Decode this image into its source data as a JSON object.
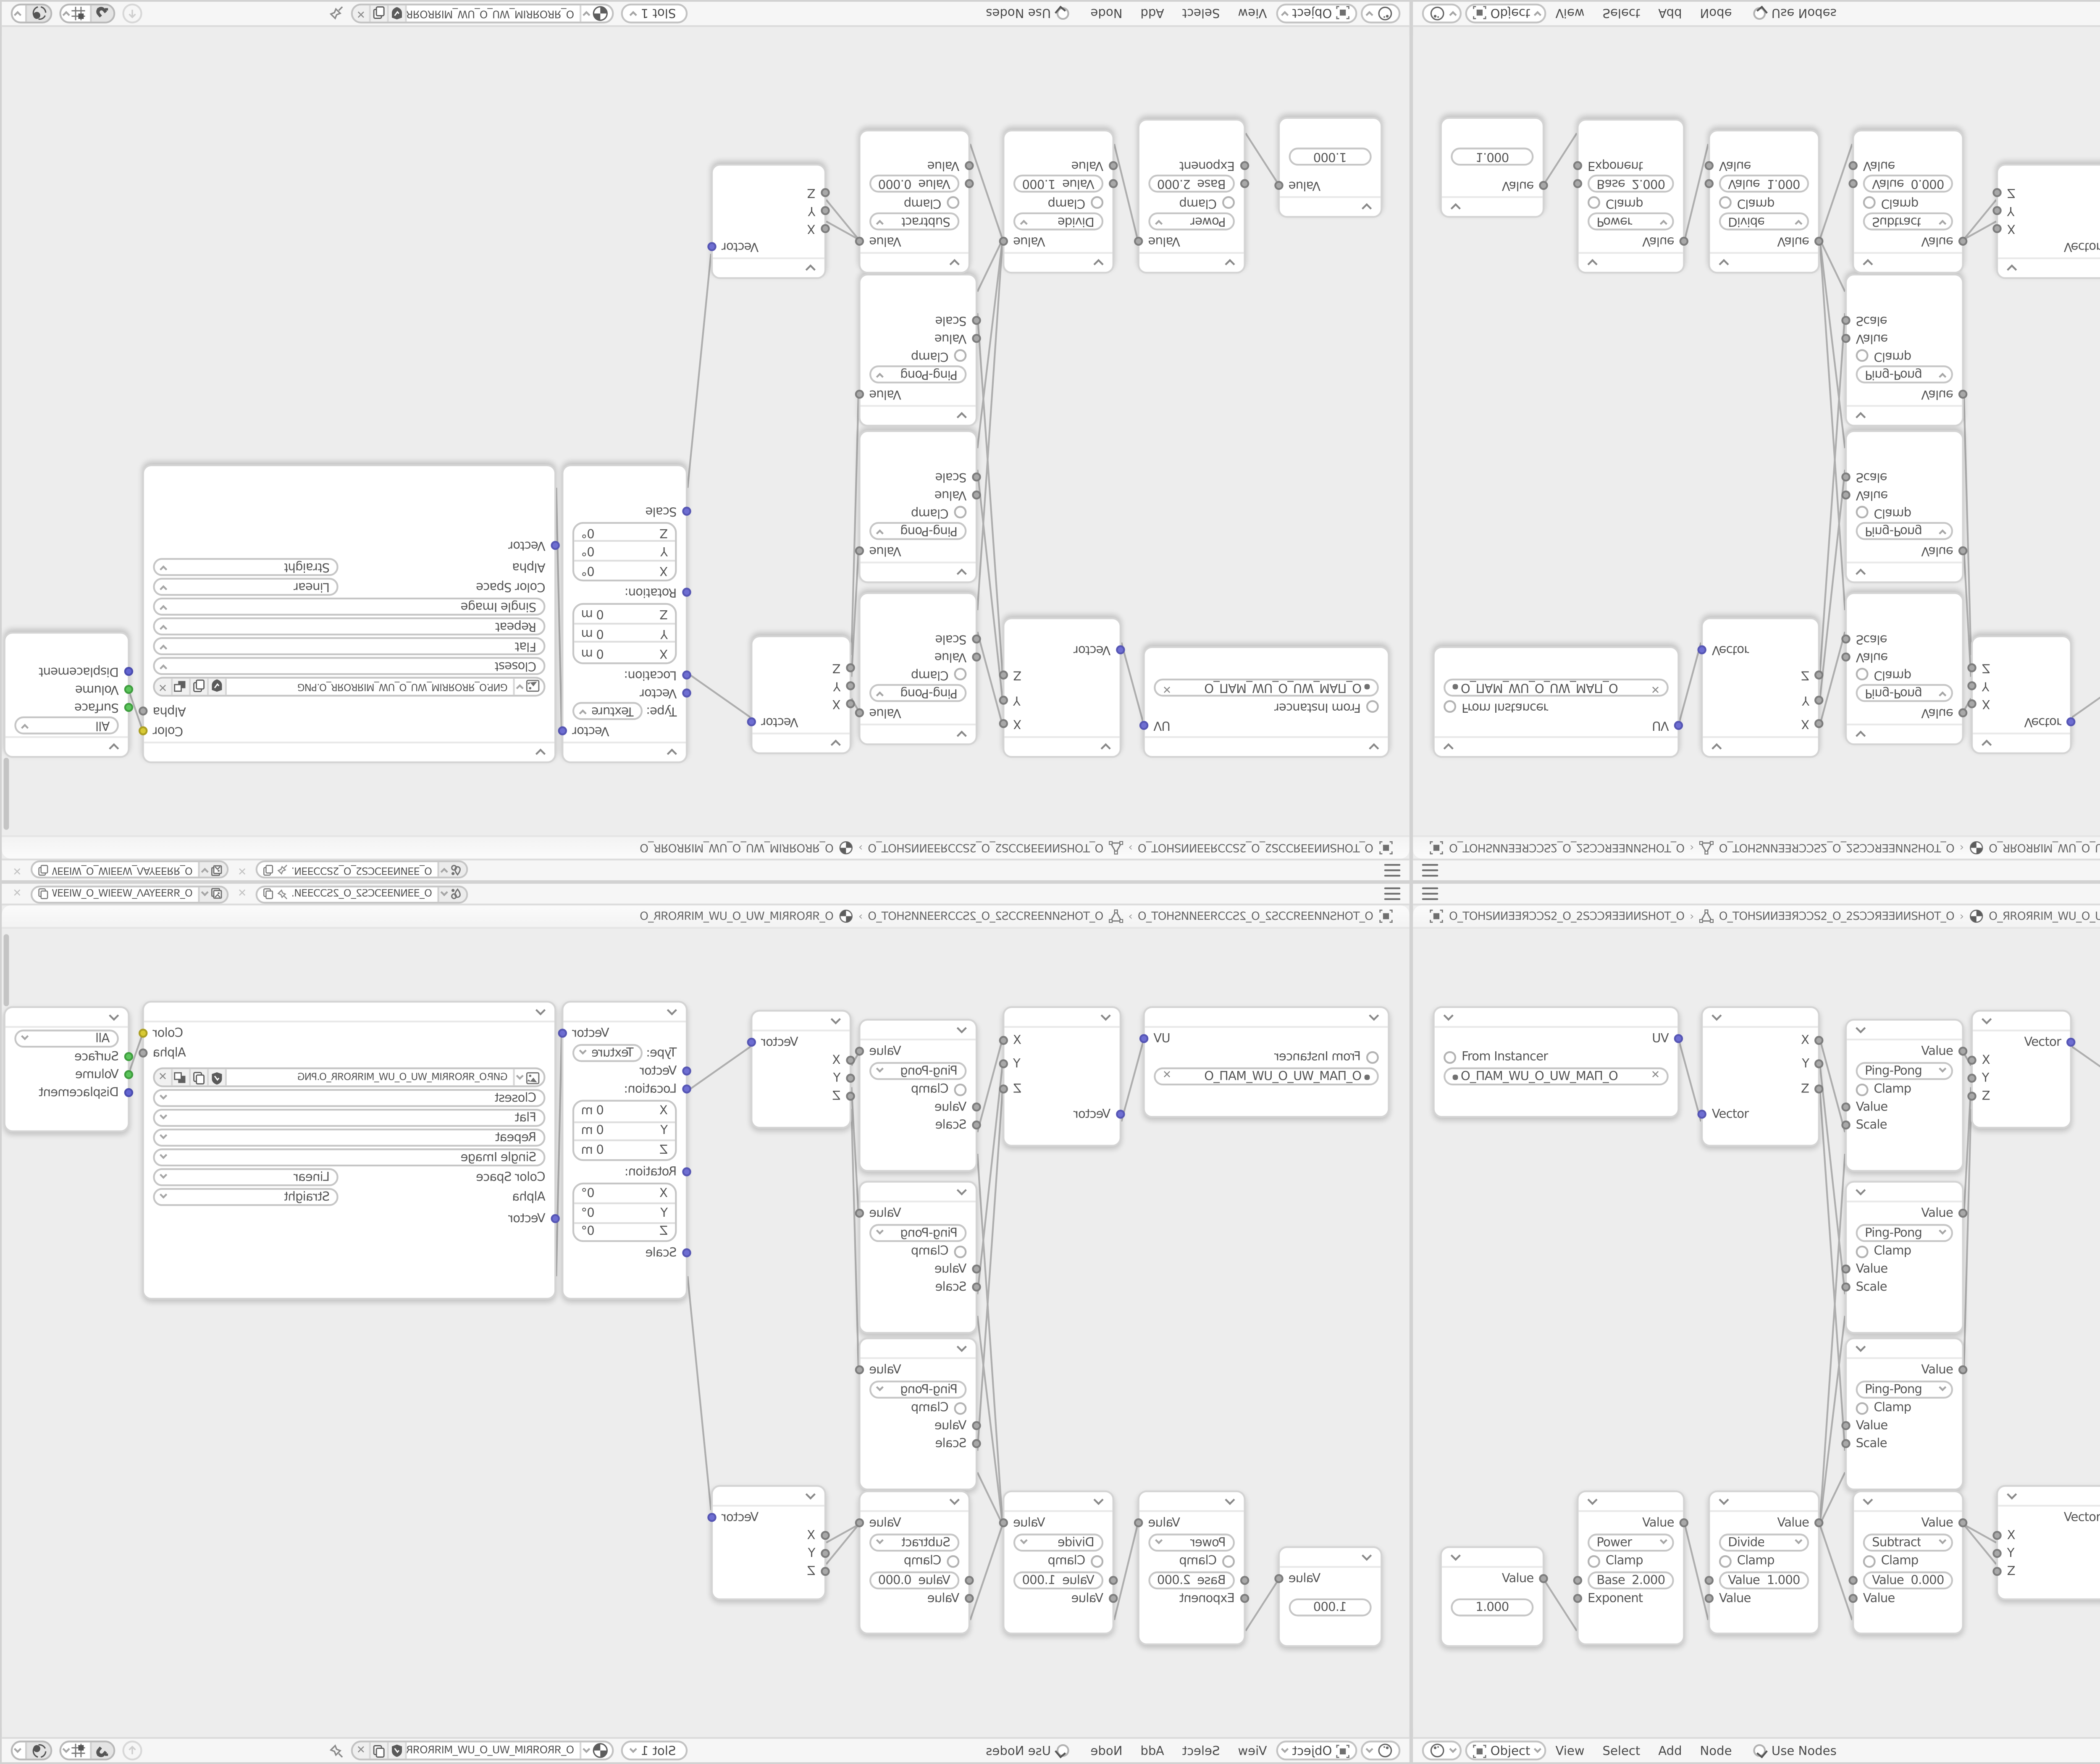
{
  "colors": {
    "canvas_bg": "#ededed",
    "bar_bg": "#f6f6f6",
    "node_bg": "#ffffff",
    "link": "#aeaeae",
    "socket_value": "#a8a8a8",
    "socket_vector": "#6e6ed2",
    "socket_color": "#d8ca35",
    "socket_shader": "#5cc55c",
    "socket_displacement": "#6365d2"
  },
  "topbar": {
    "scene_name": "O_ƎƎNИƎƎƆCS2_O_2SƆƆƎƎИ...",
    "viewlayer_name": "O_ЯЯƎƎYAΛ_WƎƎIW_O_WIƎƎW_ΛAYƎƎЯЯ_O"
  },
  "breadcrumb": {
    "object_name": "O_TOHSИИƎƎЯƆƆS2_O_2SƆƆЯƎƎИИSHOT_O",
    "mesh_name": "O_TOHSИИƎƎЯƆƆS2_O_2SƆƆЯƎƎИИSHOT_O",
    "material_name": "O_ЯROЯRIM_WU_O_UW_MIЯROЯR_O"
  },
  "header": {
    "mode": "Object",
    "menu_view": "View",
    "menu_select": "Select",
    "menu_add": "Add",
    "menu_node": "Node",
    "use_nodes": "Use Nodes",
    "slot": "Slot 1",
    "material_name": "O_ЯROЯRIM_WU_O_UW_MIЯROЯR_O"
  },
  "nodes": {
    "uv_map": {
      "out_uv": "UV",
      "from_instancer": "From Instancer",
      "uv_name": "O_ПAM_WU_O_UW_MAП_O"
    },
    "separate_xyz": {
      "out_x": "X",
      "out_y": "Y",
      "out_z": "Z",
      "in_vector": "Vector"
    },
    "ping_pong": {
      "out_value": "Value",
      "operation": "Ping-Pong",
      "clamp": "Clamp",
      "in_value": "Value",
      "in_scale": "Scale"
    },
    "combine_xyz": {
      "out_vector": "Vector",
      "in_x": "X",
      "in_y": "Y",
      "in_z": "Z"
    },
    "mapping": {
      "out_vector": "Vector",
      "type_label": "Type:",
      "type_value": "Texture",
      "in_vector": "Vector",
      "location_label": "Location:",
      "rotation_label": "Rotation:",
      "scale_label": "Scale",
      "axis_x": "X",
      "axis_y": "Y",
      "axis_z": "Z",
      "location_value": "0 m",
      "rotation_value": "0°"
    },
    "image_texture": {
      "out_color": "Color",
      "out_alpha": "Alpha",
      "image_name": "GИP.O_ЯROЯRIM_WU_O_UW_MIЯROЯR_O.PNG",
      "interpolation": "Closest",
      "projection": "Flat",
      "extension": "Repeat",
      "source": "Single Image",
      "colorspace_label": "Color Space",
      "colorspace_value": "Linear",
      "alpha_label": "Alpha",
      "alpha_value": "Straight",
      "in_vector": "Vector"
    },
    "material_output": {
      "target": "All",
      "in_surface": "Surface",
      "in_volume": "Volume",
      "in_displacement": "Displacement"
    },
    "value": {
      "out_value": "Value",
      "value": "1.000"
    },
    "power": {
      "out_value": "Value",
      "operation": "Power",
      "clamp": "Clamp",
      "field_label": "Base",
      "field_value": "2.000",
      "in_b": "Exponent"
    },
    "divide": {
      "out_value": "Value",
      "operation": "Divide",
      "clamp": "Clamp",
      "field_label": "Value",
      "field_value": "1.000",
      "in_b": "Value"
    },
    "subtract": {
      "out_value": "Value",
      "operation": "Subtract",
      "clamp": "Clamp",
      "field_label": "Value",
      "field_value": "0.000",
      "in_b": "Value"
    }
  }
}
